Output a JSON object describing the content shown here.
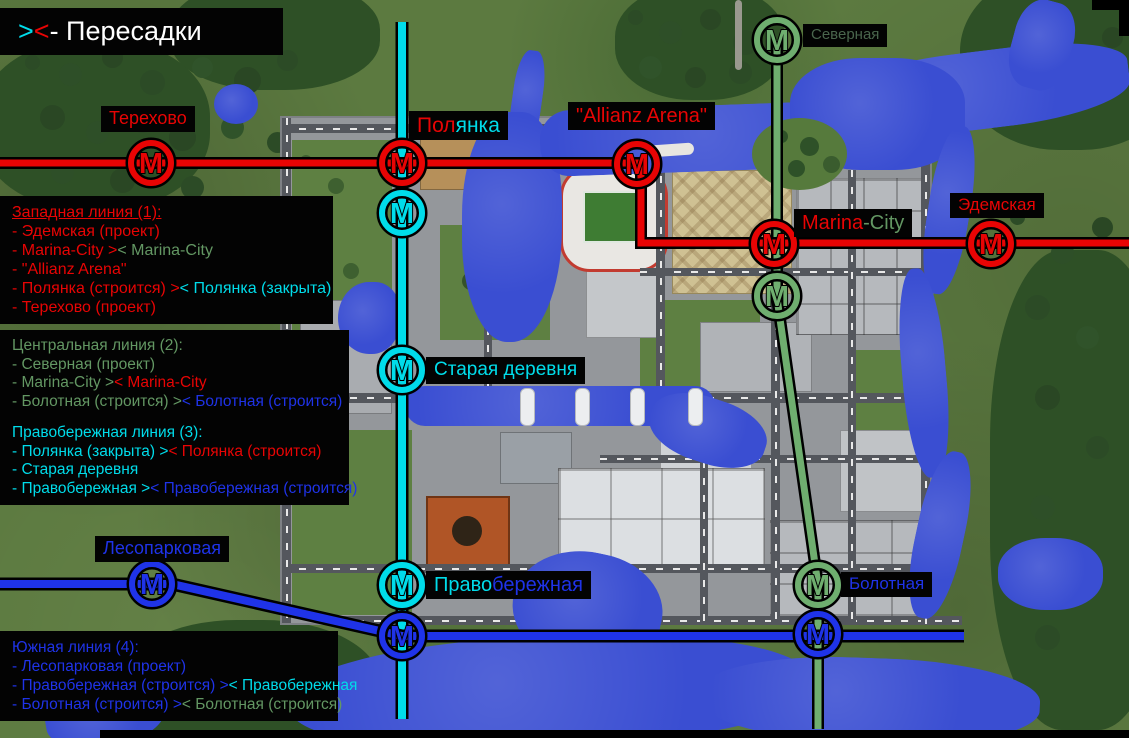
{
  "colors": {
    "red": "#e80404",
    "cyan": "#00dcea",
    "green_line": "#6fae6f",
    "green_text": "#639763",
    "green_dark_label": "#49654c",
    "blue": "#1f33e8",
    "white": "#ffffff",
    "water": "#3a4ed2"
  },
  "metro": {
    "marker_letter": "М"
  },
  "title_box": {
    "segs": [
      {
        "text": ">",
        "color": "#00dcea"
      },
      {
        "text": "<",
        "color": "#e80404"
      },
      {
        "text": " - Пересадки",
        "color": "#ffffff"
      }
    ]
  },
  "stations": {
    "terehovo": {
      "segs": [
        {
          "text": "Терехово",
          "color": "#e80404"
        }
      ]
    },
    "polyanka": {
      "segs": [
        {
          "text": "Пол",
          "color": "#e80404"
        },
        {
          "text": "янка",
          "color": "#00dcea"
        }
      ]
    },
    "allianz": {
      "segs": [
        {
          "text": "\"Allianz Arena\"",
          "color": "#e80404"
        }
      ]
    },
    "severnaya": {
      "segs": [
        {
          "text": "Северная",
          "color": "#49654c"
        }
      ]
    },
    "marina": {
      "segs": [
        {
          "text": "Marina",
          "color": "#e80404"
        },
        {
          "text": "-City",
          "color": "#639763"
        }
      ]
    },
    "edemskaya": {
      "segs": [
        {
          "text": "Эдемская",
          "color": "#e80404"
        }
      ]
    },
    "staraya": {
      "segs": [
        {
          "text": "Старая деревня",
          "color": "#00dcea"
        }
      ]
    },
    "lesoparkovaya": {
      "segs": [
        {
          "text": "Лесопарковая",
          "color": "#1f33e8"
        }
      ]
    },
    "pravoberezhnaya": {
      "segs": [
        {
          "text": "Право",
          "color": "#00dcea"
        },
        {
          "text": "бережная",
          "color": "#1f33e8"
        }
      ]
    },
    "bolotnaya": {
      "segs": [
        {
          "text": "Болотная",
          "color": "#1f33e8"
        }
      ]
    }
  },
  "legend": {
    "west": {
      "title": {
        "text": "Западная линия (1):",
        "color": "#e80404"
      },
      "items": [
        {
          "segs": [
            {
              "text": "- Эдемская (проект)",
              "color": "#e80404"
            }
          ]
        },
        {
          "segs": [
            {
              "text": "- Marina-City >",
              "color": "#e80404"
            },
            {
              "text": "< Marina-City",
              "color": "#639763"
            }
          ]
        },
        {
          "segs": [
            {
              "text": "- \"Allianz Arena\"",
              "color": "#e80404"
            }
          ]
        },
        {
          "segs": [
            {
              "text": "- Полянка (строится) >",
              "color": "#e80404"
            },
            {
              "text": "< Полянка (закрыта)",
              "color": "#00dcea"
            }
          ]
        },
        {
          "segs": [
            {
              "text": "- Терехово (проект)",
              "color": "#e80404"
            }
          ]
        }
      ]
    },
    "central": {
      "title": {
        "text": "Центральная линия (2):",
        "color": "#639763"
      },
      "items": [
        {
          "segs": [
            {
              "text": "- Северная (проект)",
              "color": "#639763"
            }
          ]
        },
        {
          "segs": [
            {
              "text": "- Marina-City >",
              "color": "#639763"
            },
            {
              "text": "< Marina-City",
              "color": "#e80404"
            }
          ]
        },
        {
          "segs": [
            {
              "text": "- Болотная (строится) >",
              "color": "#639763"
            },
            {
              "text": "< Болотная (строится)",
              "color": "#1f33e8"
            }
          ]
        }
      ]
    },
    "right_bank": {
      "title": {
        "text": "Правобережная линия (3):",
        "color": "#00dcea"
      },
      "items": [
        {
          "segs": [
            {
              "text": "- Полянка (закрыта) >",
              "color": "#00dcea"
            },
            {
              "text": "< Полянка (строится)",
              "color": "#e80404"
            }
          ]
        },
        {
          "segs": [
            {
              "text": "- Старая деревня",
              "color": "#00dcea"
            }
          ]
        },
        {
          "segs": [
            {
              "text": "- Правобережная >",
              "color": "#00dcea"
            },
            {
              "text": "< Правобережная (строится)",
              "color": "#1f33e8"
            }
          ]
        }
      ]
    },
    "south": {
      "title": {
        "text": "Южная линия (4):",
        "color": "#1f33e8"
      },
      "items": [
        {
          "segs": [
            {
              "text": "- Лесопарковая (проект)",
              "color": "#1f33e8"
            }
          ]
        },
        {
          "segs": [
            {
              "text": "- Правобережная (строится) >",
              "color": "#1f33e8"
            },
            {
              "text": "< Правобережная",
              "color": "#00dcea"
            }
          ]
        },
        {
          "segs": [
            {
              "text": "- Болотная (строится) >",
              "color": "#1f33e8"
            },
            {
              "text": "< Болотная (строится)",
              "color": "#639763"
            }
          ]
        }
      ]
    }
  }
}
